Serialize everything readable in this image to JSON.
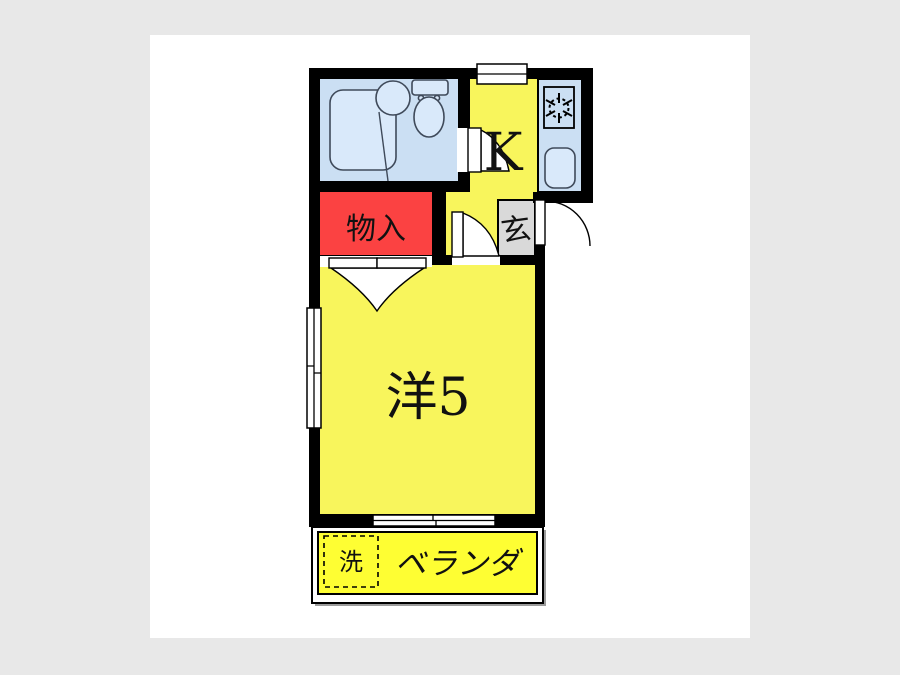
{
  "labels": {
    "kitchen": "K",
    "closet": "物入",
    "entrance": "玄",
    "western_room": "洋5",
    "balcony": "ベランダ",
    "washer": "洗"
  },
  "colors": {
    "page_bg": "#e8e8e8",
    "canvas": "#ffffff",
    "water_room_blue": "#cbdff3",
    "fixture_blue": "#d9e9fa",
    "room_yellow": "#f8f55c",
    "balcony_yellow": "#fefe33",
    "closet_red": "#fb4242",
    "entrance_gray": "#d9d9d9",
    "shadow_gray": "#9b9b9b"
  }
}
